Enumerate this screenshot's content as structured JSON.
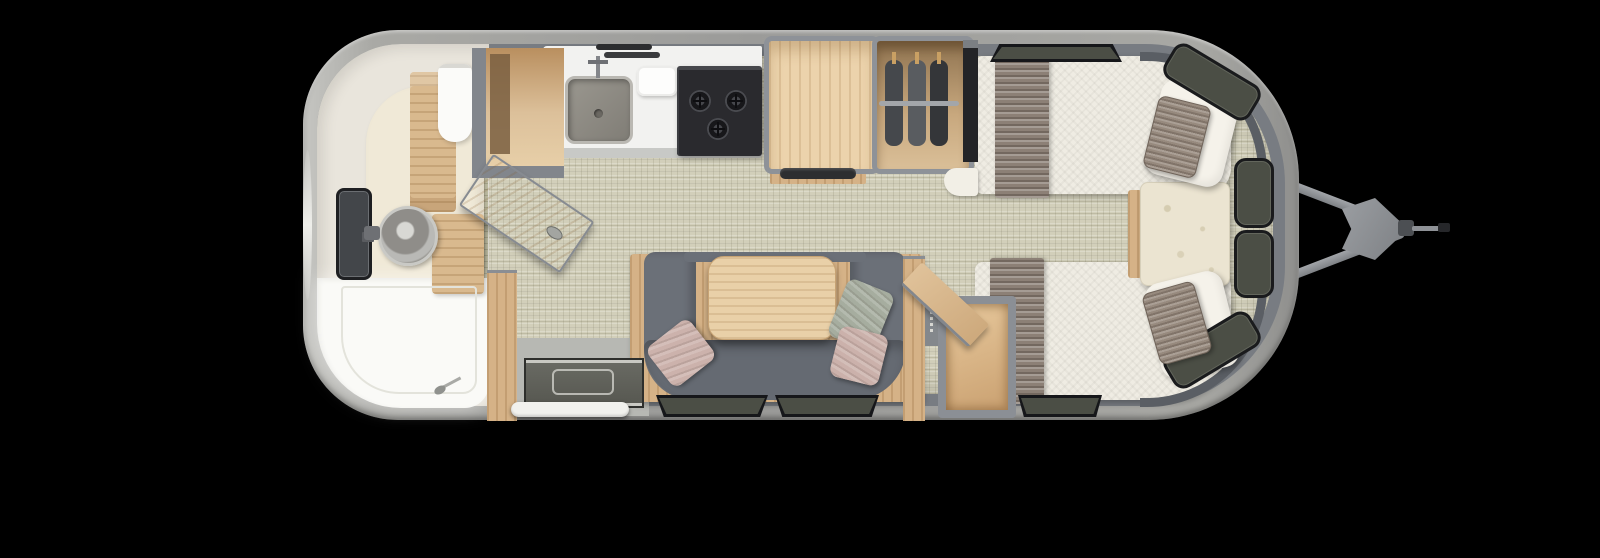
{
  "scene": {
    "type": "floor-plan",
    "subject": "travel trailer top view with tow hitch",
    "background_color": "#000000"
  },
  "palette": {
    "shell": "#a4a4a1",
    "wall": "#787c82",
    "floor_weave": "#d2cfba",
    "bathroom_cream": "#e9e5dc",
    "wood_light": "#e6cba2",
    "wood_mid": "#d5b287",
    "counter_white": "#f2f2f0",
    "sofa_gray": "#6b7078",
    "mattress": "#efece3",
    "runner_taupe": "#8c8076",
    "pillow_pink": "#ccb2ac",
    "pillow_green": "#a6ad9f",
    "pillow_taupe": "#978a7e",
    "window_glass": "#4b4e45",
    "window_frame": "#1a1b1d",
    "stove_black": "#2a2a2e",
    "fixture_white": "#fafaf7",
    "hitch_gray": "#8e9196"
  },
  "areas": {
    "trailer": {
      "label": "travel trailer floor plan, top-down view"
    },
    "bathroom": {
      "label": "rear bathroom: shower, round vanity sink, toilet, rear window, open door"
    },
    "closet": {
      "label": "closet cabinet beside bathroom"
    },
    "kitchen": {
      "label": "galley: counter, square sink, cutting board, 3-burner cooktop"
    },
    "fridge": {
      "label": "refrigerator cabinet with vent"
    },
    "wardrobe": {
      "label": "wardrobe with hanging rod and three garments"
    },
    "tv": {
      "label": "slim panel / TV beside wardrobe"
    },
    "dinette": {
      "label": "U-shaped lounge with wood table and three throw pillows"
    },
    "entry": {
      "label": "entry doorway with floor grate and step"
    },
    "storage_box": {
      "label": "open-lid storage compartment at foot of curbside bed"
    },
    "bed_street": {
      "label": "streetside twin bed with runner and pillows"
    },
    "bed_curb": {
      "label": "curbside twin bed with runner and pillows"
    },
    "nightstand": {
      "label": "front nightstand between twin beds"
    },
    "front_windows": {
      "label": "wrap-around front windows"
    },
    "hitch": {
      "label": "A-frame tow hitch with propane cover and coupler"
    }
  }
}
